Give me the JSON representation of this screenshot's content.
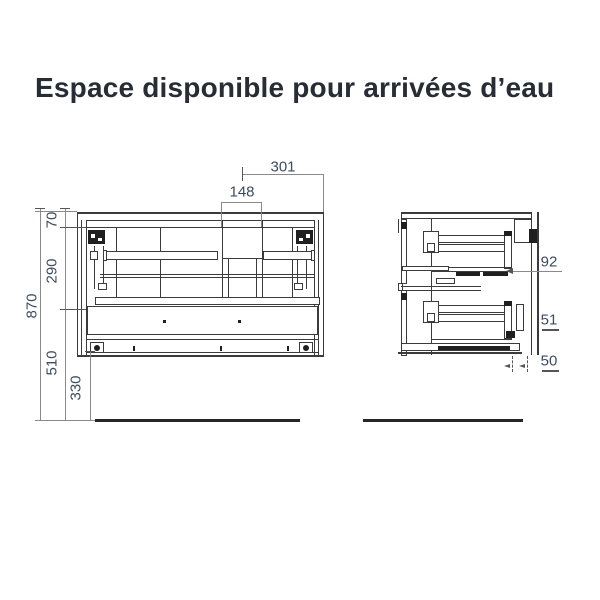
{
  "title": "Espace disponible pour arrivées d’eau",
  "views": {
    "front": {
      "name": "front elevation of wall-hung vanity unit",
      "dims": {
        "d870": "870",
        "d70": "70",
        "d290": "290",
        "d510": "510",
        "d330": "330",
        "d301": "301",
        "d148": "148"
      }
    },
    "side": {
      "name": "side section of vanity unit",
      "dims": {
        "d92": "92",
        "d51": "51",
        "d50": "50"
      }
    }
  },
  "colors": {
    "title_color": "#272c35",
    "dim_text": "#3d4b61",
    "line": "#3b3b3b",
    "dim_line": "#8a8a8a",
    "floor": "#262626"
  }
}
